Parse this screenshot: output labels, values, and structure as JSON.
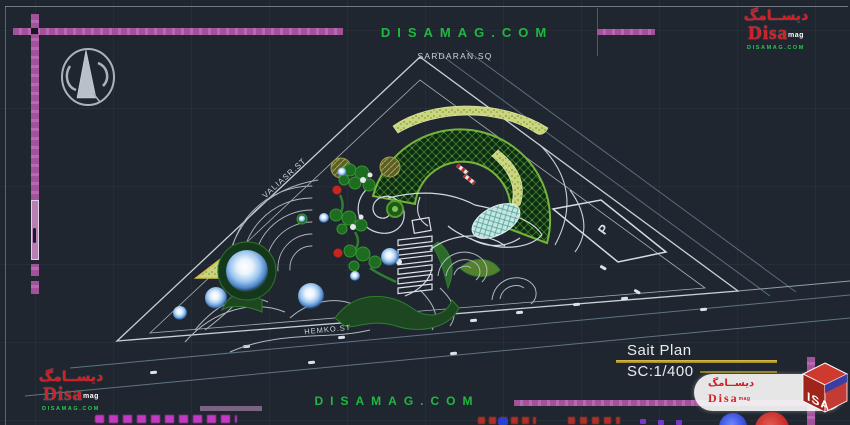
{
  "colors": {
    "background": "#20262f",
    "magenta_line": "#a855a2",
    "watermark_green": "#1fb93f",
    "title_yellow": "#caa52c",
    "logo_red": "#d41e26",
    "drawing_white": "#c7d0d8",
    "road_teal": "#5f7484"
  },
  "header": {
    "watermark": "DISAMAG.COM",
    "square_label": "SARDARAN.SQ"
  },
  "plan": {
    "street_left": "VALIASR.ST",
    "street_bottom": "HEMKO.ST",
    "parking_label": "P"
  },
  "title_block": {
    "title": "Sait Plan",
    "scale": "SC:1/400"
  },
  "footer": {
    "watermark": "DISAMAG.COM"
  },
  "brand": {
    "persian": "دیســامگ",
    "name": "Disa",
    "suffix": "mag",
    "site": "DISAMAG.COM",
    "cube_text": "ISA"
  }
}
